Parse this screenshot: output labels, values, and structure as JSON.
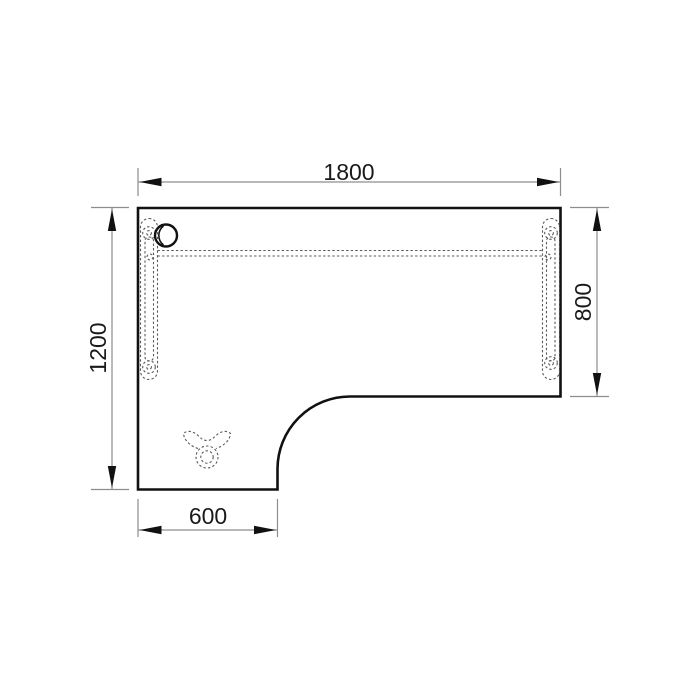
{
  "drawing": {
    "type": "furniture-technical-drawing",
    "subject": "L-shaped desk top view with understructure shown dashed",
    "dimensions": {
      "top_width": "1800",
      "left_depth": "1200",
      "right_depth": "800",
      "bottom_return_width": "600"
    },
    "colors": {
      "background": "#ffffff",
      "outline": "#111111",
      "dimension_lines": "#8d8d8d",
      "dimension_text": "#1a1a1a",
      "hidden_detail_dashed": "#5a5a5a"
    }
  }
}
